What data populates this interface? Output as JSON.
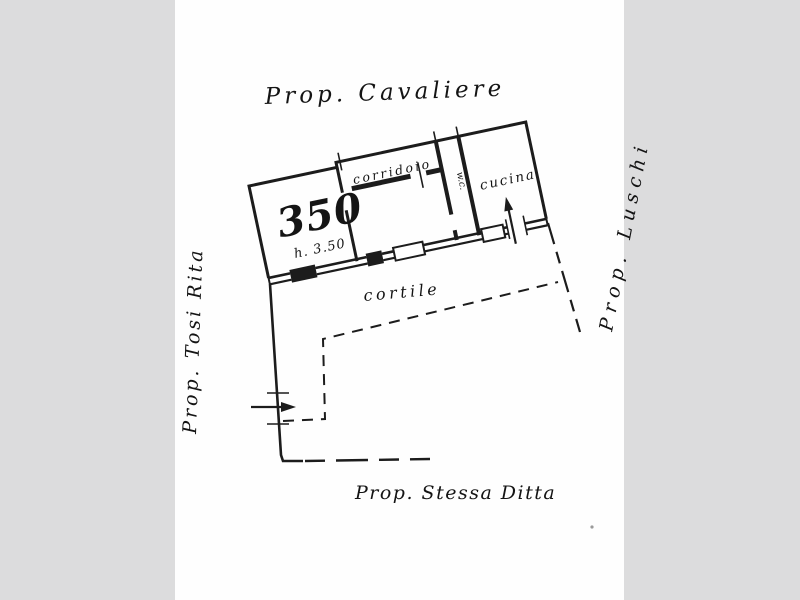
{
  "page": {
    "margin_color": "#dcdcdd",
    "paper_color": "#fefefe",
    "ink_color": "#1c1c1c"
  },
  "plan": {
    "neighbors": {
      "north": "Prop. Cavaliere",
      "west": "Prop. Tosi Rita",
      "east": "Prop. Luschi",
      "south": "Prop. Stessa Ditta"
    },
    "rooms": {
      "parcel_number": "350",
      "height_note": "h. 3.50",
      "corridor": "corridoio",
      "kitchen": "cucina",
      "wc": "w.c.",
      "courtyard": "cortile"
    }
  }
}
